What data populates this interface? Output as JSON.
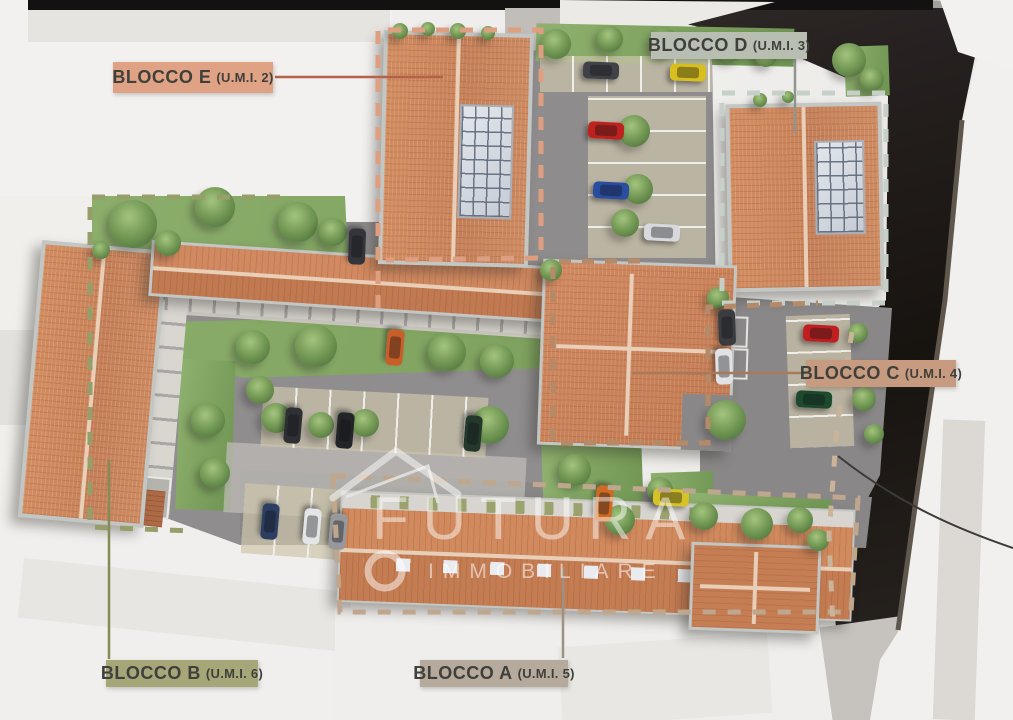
{
  "scene_type": "aerial 3D site-plan rendering of a residential complex with labeled building blocks",
  "watermark": {
    "brand": "FUTURA",
    "subtitle": "IMMOBILIARE",
    "logo": "house-outline-and-ring",
    "color": "#FFFFFF"
  },
  "labels": [
    {
      "block": "BLOCCO E",
      "umi": "(U.M.I. 2)",
      "bg": "#DFA284",
      "leader": "#B5614A"
    },
    {
      "block": "BLOCCO D",
      "umi": "(U.M.I. 3)",
      "bg": "#B9BEB2",
      "leader": "#8F968F"
    },
    {
      "block": "BLOCCO C",
      "umi": "(U.M.I. 4)",
      "bg": "#C79B80",
      "leader": "#A87A5C"
    },
    {
      "block": "BLOCCO B",
      "umi": "(U.M.I. 6)",
      "bg": "#A6A678",
      "leader": "#858B56"
    },
    {
      "block": "BLOCCO A",
      "umi": "(U.M.I. 5)",
      "bg": "#B6AA9C",
      "leader": "#9D9183"
    }
  ],
  "outlines": {
    "blocco_e": "#DD9F80",
    "blocco_d": "#C6CFC8",
    "blocco_c": "#B58A69",
    "blocco_b": "#969F6A",
    "blocco_a": "#BFA78E",
    "street_edge": "#C9B49A"
  },
  "palette": {
    "roof_tile": "#C9855B",
    "ridge": "#E9CFB8",
    "asphalt": "#8E8B8C",
    "parking_stall": "#CDC5AB",
    "grass": "#87A766",
    "dark_street": "#221E1B",
    "white_massing": "#F0EFED",
    "solar_panel": "#D6DBE2",
    "label_text": "#3F403B"
  },
  "scene": {
    "trees": [
      {
        "x": 133,
        "y": 224,
        "r": 24
      },
      {
        "x": 215,
        "y": 207,
        "r": 20
      },
      {
        "x": 168,
        "y": 243,
        "r": 13
      },
      {
        "x": 298,
        "y": 222,
        "r": 20
      },
      {
        "x": 333,
        "y": 232,
        "r": 14
      },
      {
        "x": 101,
        "y": 250,
        "r": 9
      },
      {
        "x": 556,
        "y": 44,
        "r": 15
      },
      {
        "x": 610,
        "y": 39,
        "r": 13
      },
      {
        "x": 664,
        "y": 43,
        "r": 15
      },
      {
        "x": 729,
        "y": 49,
        "r": 13
      },
      {
        "x": 766,
        "y": 56,
        "r": 11
      },
      {
        "x": 849,
        "y": 60,
        "r": 17
      },
      {
        "x": 872,
        "y": 79,
        "r": 12
      },
      {
        "x": 634,
        "y": 131,
        "r": 16
      },
      {
        "x": 638,
        "y": 189,
        "r": 15
      },
      {
        "x": 625,
        "y": 223,
        "r": 14
      },
      {
        "x": 551,
        "y": 270,
        "r": 11
      },
      {
        "x": 718,
        "y": 298,
        "r": 11
      },
      {
        "x": 726,
        "y": 420,
        "r": 20
      },
      {
        "x": 253,
        "y": 347,
        "r": 17
      },
      {
        "x": 316,
        "y": 346,
        "r": 21
      },
      {
        "x": 447,
        "y": 352,
        "r": 19
      },
      {
        "x": 497,
        "y": 361,
        "r": 17
      },
      {
        "x": 276,
        "y": 418,
        "r": 15
      },
      {
        "x": 321,
        "y": 425,
        "r": 13
      },
      {
        "x": 365,
        "y": 423,
        "r": 14
      },
      {
        "x": 490,
        "y": 425,
        "r": 19
      },
      {
        "x": 208,
        "y": 420,
        "r": 17
      },
      {
        "x": 215,
        "y": 473,
        "r": 15
      },
      {
        "x": 260,
        "y": 390,
        "r": 14
      },
      {
        "x": 575,
        "y": 470,
        "r": 16
      },
      {
        "x": 620,
        "y": 520,
        "r": 15
      },
      {
        "x": 660,
        "y": 490,
        "r": 13
      },
      {
        "x": 704,
        "y": 516,
        "r": 14
      },
      {
        "x": 757,
        "y": 524,
        "r": 16
      },
      {
        "x": 800,
        "y": 520,
        "r": 13
      },
      {
        "x": 818,
        "y": 540,
        "r": 11
      },
      {
        "x": 858,
        "y": 333,
        "r": 10
      },
      {
        "x": 864,
        "y": 399,
        "r": 12
      },
      {
        "x": 874,
        "y": 434,
        "r": 10
      },
      {
        "x": 400,
        "y": 31,
        "r": 8
      },
      {
        "x": 428,
        "y": 29,
        "r": 7
      },
      {
        "x": 458,
        "y": 31,
        "r": 8
      },
      {
        "x": 488,
        "y": 33,
        "r": 7
      },
      {
        "x": 760,
        "y": 100,
        "r": 7
      },
      {
        "x": 788,
        "y": 97,
        "r": 6
      }
    ],
    "cars": [
      {
        "x": 601,
        "y": 70,
        "deg": 2,
        "c": "#404247"
      },
      {
        "x": 688,
        "y": 72,
        "deg": 2,
        "c": "#d9bf1d"
      },
      {
        "x": 606,
        "y": 130,
        "deg": 3,
        "c": "#bd221e"
      },
      {
        "x": 611,
        "y": 190,
        "deg": 3,
        "c": "#2a4da0"
      },
      {
        "x": 662,
        "y": 232,
        "deg": 3,
        "c": "#d8d9dc"
      },
      {
        "x": 357,
        "y": 246,
        "deg": 92,
        "c": "#33353a"
      },
      {
        "x": 395,
        "y": 347,
        "deg": 95,
        "c": "#c95f28"
      },
      {
        "x": 293,
        "y": 425,
        "deg": 95,
        "c": "#2e3033"
      },
      {
        "x": 345,
        "y": 430,
        "deg": 95,
        "c": "#232528"
      },
      {
        "x": 473,
        "y": 433,
        "deg": 95,
        "c": "#24382c"
      },
      {
        "x": 727,
        "y": 327,
        "deg": 88,
        "c": "#3a3c40"
      },
      {
        "x": 724,
        "y": 366,
        "deg": 88,
        "c": "#e2e2e4"
      },
      {
        "x": 821,
        "y": 333,
        "deg": 3,
        "c": "#bf1f1f"
      },
      {
        "x": 814,
        "y": 399,
        "deg": 3,
        "c": "#1d4a2d"
      },
      {
        "x": 270,
        "y": 521,
        "deg": 95,
        "c": "#2c3e62"
      },
      {
        "x": 312,
        "y": 526,
        "deg": 95,
        "c": "#e4e5e7"
      },
      {
        "x": 338,
        "y": 531,
        "deg": 95,
        "c": "#97989b"
      },
      {
        "x": 604,
        "y": 503,
        "deg": 95,
        "c": "#cf6a22"
      },
      {
        "x": 671,
        "y": 497,
        "deg": 3,
        "c": "#d6c226"
      }
    ]
  }
}
